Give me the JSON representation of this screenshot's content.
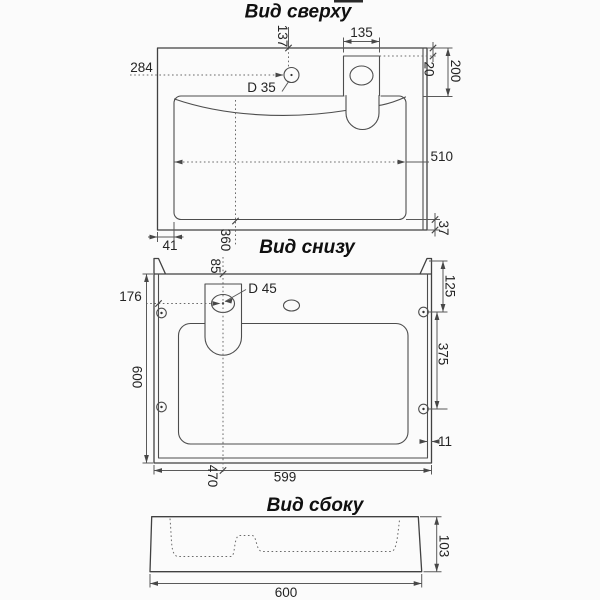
{
  "colors": {
    "line": "#414141",
    "dim_line": "#5a5a5a",
    "text": "#242424",
    "background": "#fbfbfb"
  },
  "views": {
    "top": {
      "title": "Вид сверху",
      "dims": {
        "d137": "137",
        "d135": "135",
        "d284": "284",
        "d20": "20",
        "d200": "200",
        "d35": "D 35",
        "d510": "510",
        "d41": "41",
        "d360": "360",
        "d37": "37"
      }
    },
    "bottom": {
      "title": "Вид снизу",
      "dims": {
        "d85": "85",
        "d45": "D 45",
        "d176": "176",
        "d600": "600",
        "d125": "125",
        "d375": "375",
        "d11": "11",
        "d470": "470",
        "d599": "599"
      }
    },
    "side": {
      "title": "Вид сбоку",
      "dims": {
        "d600": "600",
        "d103": "103"
      }
    }
  }
}
